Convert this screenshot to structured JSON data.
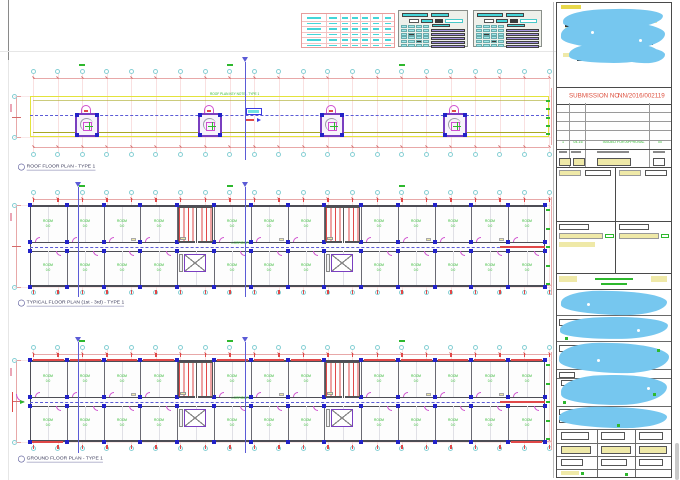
{
  "colors": {
    "cyan": "#45d5d8",
    "cyan_fill": "#9fe8ea",
    "red": "#e04848",
    "dim_red": "#e8a8a8",
    "grid_red": "#f6d3d3",
    "green": "#2eb82e",
    "blue": "#2a2ad0",
    "section_blue": "#5b5bd6",
    "magenta": "#cf4fcf",
    "yellow": "#e3e33c",
    "olive": "#a8a824",
    "purple": "#7a3fc0",
    "lavender": "#a393dd",
    "wall": "#4d4d55",
    "column_blue": "#2222c8",
    "blob": "#76c7ef",
    "chip_yellow": "#efe9a8",
    "table_red": "#e89c9c",
    "table_red_light": "#f3c3c3",
    "submission_red": "#dd4f3d"
  },
  "plans": [
    {
      "id": "roof",
      "label": "ROOF FLOOR PLAN - TYPE 1",
      "note": "ROOF PLAN KEY NOTE - TYPE 1"
    },
    {
      "id": "typical",
      "label": "TYPICAL FLOOR PLAN (1st - 3rd) - TYPE 1",
      "corridor_text": "CORRIDOR"
    },
    {
      "id": "ground",
      "label": "GROUND FLOOR PLAN - TYPE 1",
      "corridor_text": "CORRIDOR"
    }
  ],
  "room": {
    "label": "ROOM",
    "area": "0.0"
  },
  "title_block": {
    "submission_label": "SUBMISSION NO :",
    "submission_number": "NN/2016/002119",
    "revision": {
      "no": "1",
      "date": "04-16",
      "description": "ISSUED FOR APPROVAL",
      "initials": "00"
    }
  }
}
